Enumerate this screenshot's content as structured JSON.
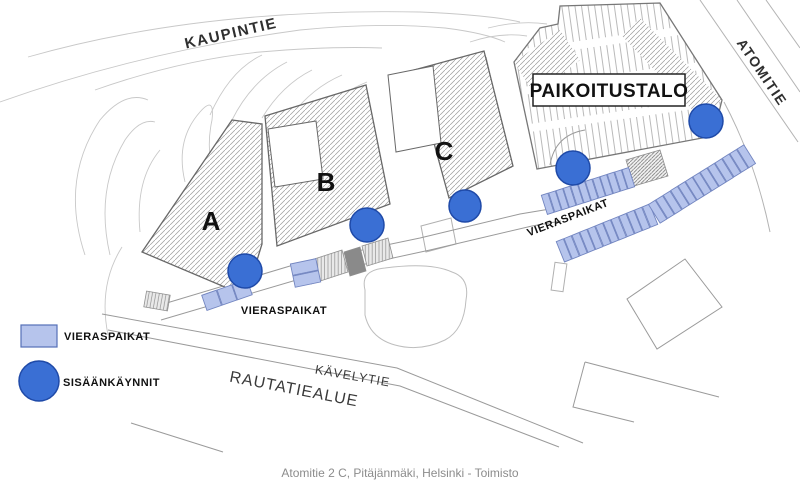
{
  "map": {
    "streets": {
      "kaupintie": "KAUPINTIE",
      "atomitie": "ATOMITIE",
      "kavelytie": "KÄVELYTIE",
      "rautatiealue": "RAUTATIEALUE"
    },
    "buildings": {
      "a": "A",
      "b": "B",
      "c": "C"
    },
    "parking_garage_label": "PAIKOITUSTALO",
    "visitor_parking_label_left": "VIERASPAIKAT",
    "visitor_parking_label_right": "VIERASPAIKAT",
    "entrances": [
      {
        "x": 245,
        "y": 271,
        "r": 17
      },
      {
        "x": 367,
        "y": 225,
        "r": 17
      },
      {
        "x": 465,
        "y": 206,
        "r": 16
      },
      {
        "x": 573,
        "y": 168,
        "r": 17
      },
      {
        "x": 706,
        "y": 121,
        "r": 17
      }
    ],
    "parking_rows": [
      {
        "x1": 560,
        "y1": 252,
        "x2": 654,
        "y2": 214,
        "count": 12,
        "depth": 22
      },
      {
        "x1": 654,
        "y1": 214,
        "x2": 750,
        "y2": 154,
        "count": 13,
        "depth": 22
      },
      {
        "x1": 544,
        "y1": 205,
        "x2": 632,
        "y2": 177,
        "count": 12,
        "depth": 20
      },
      {
        "x1": 303,
        "y1": 261,
        "x2": 308,
        "y2": 285,
        "count": 2,
        "depth": 26
      },
      {
        "x1": 204,
        "y1": 303,
        "x2": 250,
        "y2": 287,
        "count": 3,
        "depth": 16
      }
    ]
  },
  "legend": {
    "items": [
      {
        "label": "VIERASPAIKAT"
      },
      {
        "label": "SISÄÄNKÄYNNIT"
      }
    ]
  },
  "caption": "Atomitie 2 C, Pitäjänmäki, Helsinki - Toimisto",
  "colors": {
    "entrance_fill": "#3a6fd4",
    "entrance_stroke": "#1f4aa8",
    "parking_fill": "#b6c4ec",
    "parking_stroke": "#7285c0"
  }
}
